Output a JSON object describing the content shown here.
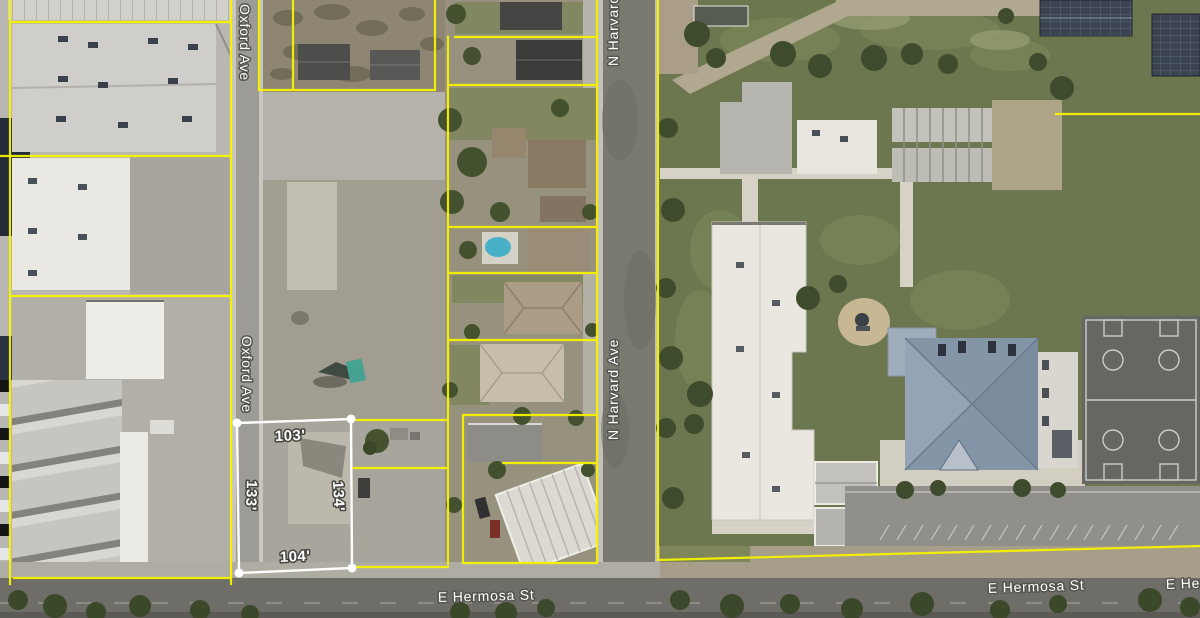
{
  "map": {
    "view": "aerial-parcel-map",
    "streets": {
      "oxford_ave_top": "Oxford Ave",
      "oxford_ave_mid": "Oxford Ave",
      "n_harvard_ave_top": "N Harvard Ave",
      "n_harvard_ave_mid": "N Harvard Ave",
      "e_hermosa_st_left": "E Hermosa St",
      "e_hermosa_st_right": "E Hermosa St",
      "e_hermosa_st_far_right": "E Hermosa St"
    },
    "subject_parcel": {
      "dimensions": {
        "north": "103'",
        "west": "133'",
        "east": "134'",
        "south": "104'"
      },
      "outline_color": "#ffffff"
    },
    "overlay": {
      "parcel_line_color": "#f6f200"
    }
  }
}
